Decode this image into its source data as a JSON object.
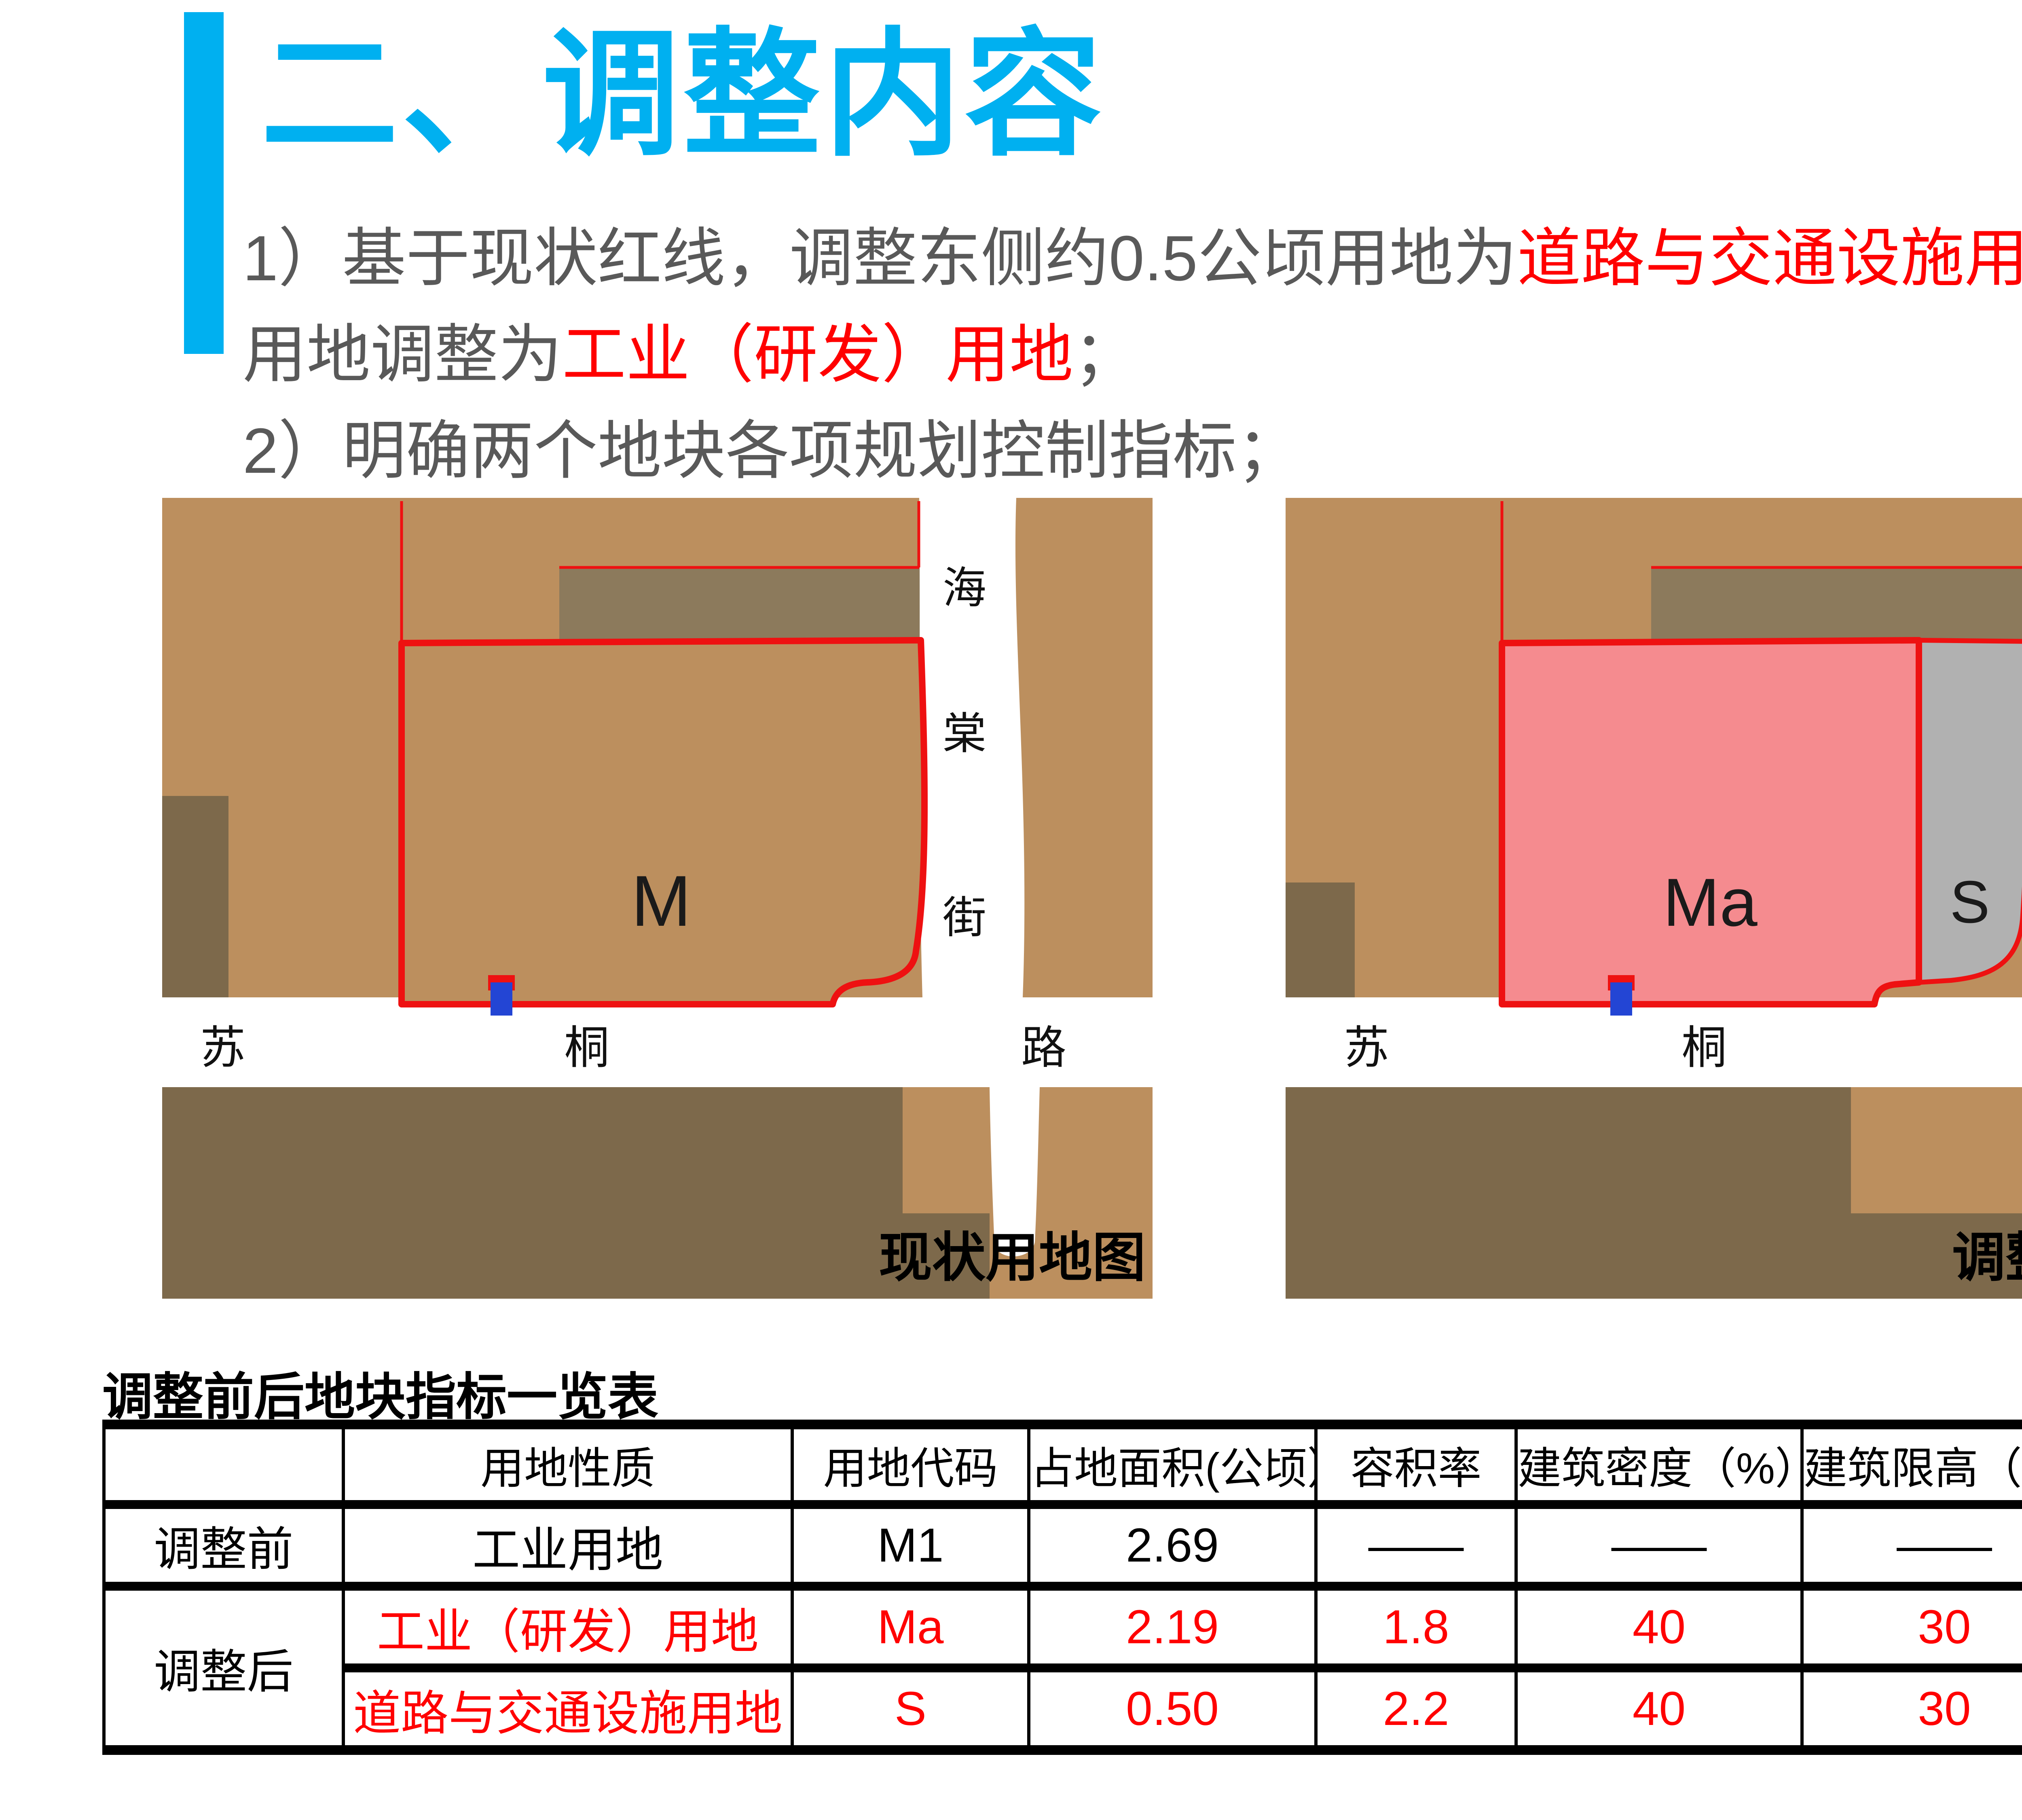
{
  "title": "二、调整内容",
  "accent_color": "#00B0F0",
  "intro": {
    "text_color": "#595959",
    "highlight_color": "#FF0000",
    "lines": [
      [
        {
          "t": "1）基于现状红线，调整东侧约0.5公顷用地为"
        },
        {
          "t": "道路与交通设施用地",
          "red": true
        },
        {
          "t": "，其余"
        }
      ],
      [
        {
          "t": "用地调整为"
        },
        {
          "t": "工业（研发）用地",
          "red": true
        },
        {
          "t": "；"
        }
      ],
      [
        {
          "t": "2）明确两个地块各项规划控制指标；"
        }
      ]
    ]
  },
  "maps": {
    "colors": {
      "parcel_tan": "#BC8F5E",
      "parcel_dark": "#7D694B",
      "building_dark": "#8C7A5C",
      "road_white": "#FFFFFF",
      "redline": "#EE1111",
      "parcel_pink": "#F58B8F",
      "parcel_gray": "#B1B1B1",
      "marker_blue": "#2345D4"
    },
    "left": {
      "caption": "现状用地图",
      "parcel_label": "M",
      "street_vertical": [
        "海",
        "棠",
        "街"
      ],
      "road_horizontal": [
        "苏",
        "桐",
        "路"
      ]
    },
    "right": {
      "caption": "调整后用地图",
      "parcel_main": "Ma",
      "parcel_east": "S",
      "street_vertical": [
        "海",
        "棠",
        "街"
      ],
      "road_horizontal": [
        "苏",
        "桐",
        "路"
      ]
    }
  },
  "table": {
    "title": "调整前后地块指标一览表",
    "headers": [
      "",
      "用地性质",
      "用地代码",
      "占地面积(公顷）",
      "容积率",
      "建筑密度（%）",
      "建筑限高（米）",
      "绿化率（%）"
    ],
    "rows": [
      {
        "label": "调整前",
        "cells": [
          "工业用地",
          "M1",
          "2.69",
          "——",
          "——",
          "——",
          "——"
        ]
      },
      {
        "label": "调整后",
        "cells": [
          "工业（研发）用地",
          "Ma",
          "2.19",
          "1.8",
          "40",
          "30",
          "30"
        ]
      },
      {
        "label": "",
        "cells": [
          "道路与交通设施用地",
          "S",
          "0.50",
          "2.2",
          "40",
          "30",
          "15"
        ]
      }
    ]
  }
}
